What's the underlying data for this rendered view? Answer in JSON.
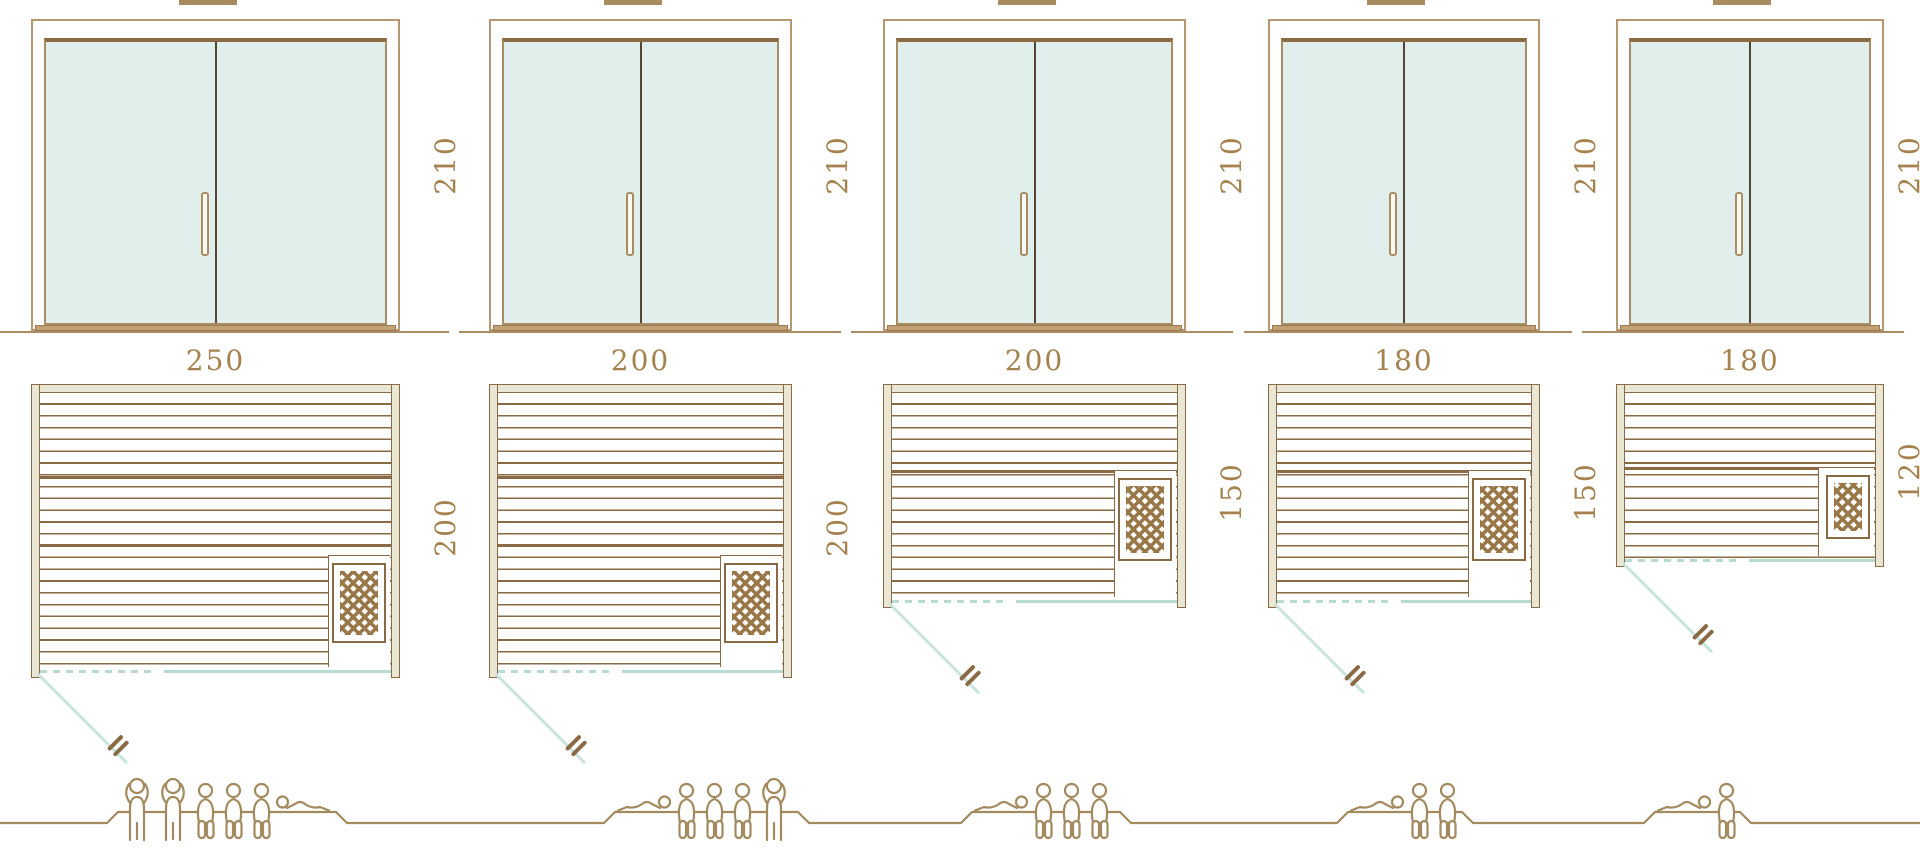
{
  "page": {
    "background": "#ffffff"
  },
  "palette": {
    "line_brown": "#8a6a45",
    "frame_tan": "#b59772",
    "fill_beige": "#e9e6d3",
    "glass_teal": "#e0efec",
    "teal_line": "#b7dad3",
    "label_brown": "#a5824d",
    "people_brown": "#a38a5e",
    "sill_tan": "#c2a177"
  },
  "cabins": [
    {
      "name": "sauna-cabin-250x200",
      "height_label": "210",
      "width_label": "250",
      "depth_label": "200",
      "height_cm": 210,
      "width_cm": 250,
      "depth_cm": 200,
      "capacity": 6,
      "occupants": [
        "standing",
        "standing",
        "sitting",
        "sitting",
        "sitting",
        "lying-mirrored"
      ]
    },
    {
      "name": "sauna-cabin-200x200",
      "height_label": "210",
      "width_label": "200",
      "depth_label": "200",
      "height_cm": 210,
      "width_cm": 200,
      "depth_cm": 200,
      "capacity": 5,
      "occupants": [
        "lying",
        "sitting",
        "sitting",
        "sitting",
        "standing"
      ]
    },
    {
      "name": "sauna-cabin-200x150",
      "height_label": "210",
      "width_label": "200",
      "depth_label": "150",
      "height_cm": 210,
      "width_cm": 200,
      "depth_cm": 150,
      "capacity": 4,
      "occupants": [
        "lying",
        "sitting",
        "sitting",
        "sitting"
      ]
    },
    {
      "name": "sauna-cabin-180x150",
      "height_label": "210",
      "width_label": "180",
      "depth_label": "150",
      "height_cm": 210,
      "width_cm": 180,
      "depth_cm": 150,
      "capacity": 3,
      "occupants": [
        "lying",
        "sitting",
        "sitting"
      ]
    },
    {
      "name": "sauna-cabin-180x120",
      "height_label": "210",
      "width_label": "180",
      "depth_label": "120",
      "height_cm": 210,
      "width_cm": 180,
      "depth_cm": 120,
      "capacity": 2,
      "occupants": [
        "lying",
        "sitting"
      ]
    }
  ]
}
